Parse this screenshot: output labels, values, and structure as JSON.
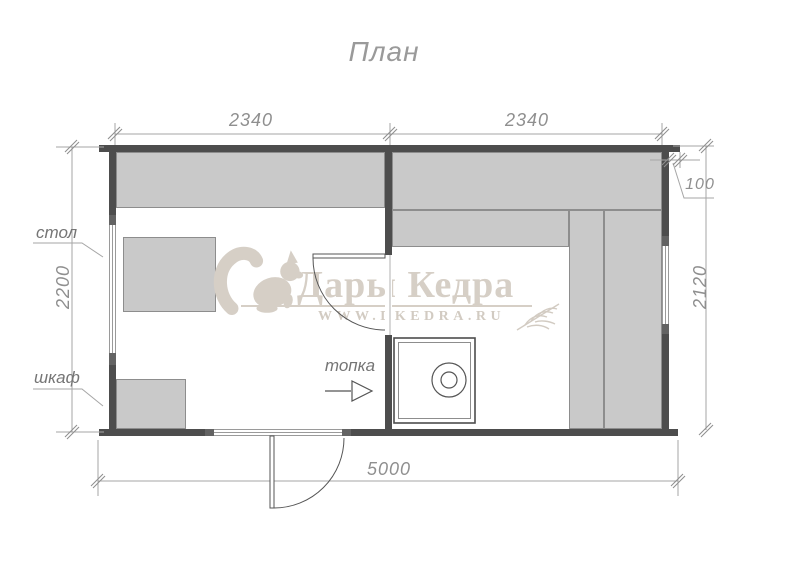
{
  "title": "План",
  "dimensions": {
    "top_left_room_width": "2340",
    "top_right_room_width": "2340",
    "roof_overhang": "100",
    "left_depth": "2200",
    "right_depth": "2120",
    "total_length": "5000"
  },
  "labels": {
    "table": "стол",
    "cabinet": "шкаф",
    "firebox": "топка"
  },
  "watermark": {
    "brand": "Дары Кедра",
    "url": "WWW.DKEDRA.RU",
    "icons": [
      "squirrel-silhouette",
      "wheat-sprig"
    ]
  },
  "colors": {
    "wall": "#4d4d4d",
    "furniture": "#c9c9c9",
    "furniture_outline": "#8d8d8d",
    "dimension_text": "#8f8f8f",
    "dimension_line": "#a6a6a6",
    "watermark": "#d6cfc6"
  }
}
